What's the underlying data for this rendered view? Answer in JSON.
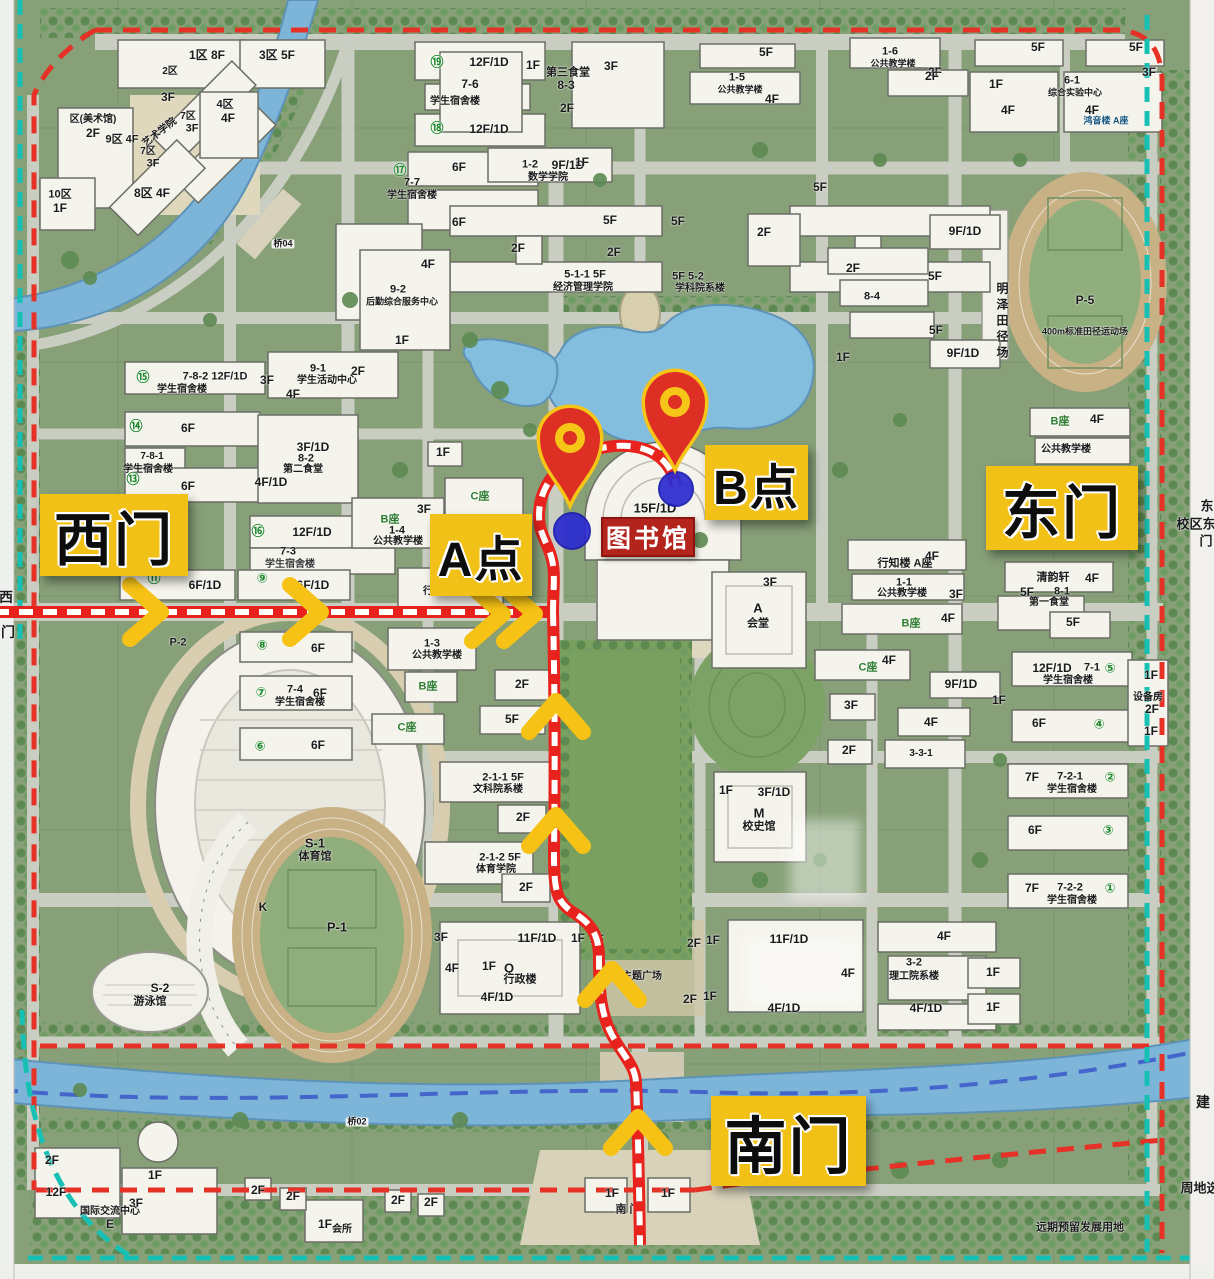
{
  "overlay": {
    "gates": [
      {
        "id": "west-gate",
        "label": "西门",
        "x": 40,
        "y": 494,
        "w": 148,
        "h": 82,
        "fs": 58
      },
      {
        "id": "east-gate",
        "label": "东门",
        "x": 986,
        "y": 466,
        "w": 152,
        "h": 84,
        "fs": 58
      },
      {
        "id": "south-gate",
        "label": "南门",
        "x": 711,
        "y": 1096,
        "w": 155,
        "h": 90,
        "fs": 62
      },
      {
        "id": "point-a",
        "label": "A点",
        "x": 430,
        "y": 514,
        "w": 102,
        "h": 82,
        "fs": 48
      },
      {
        "id": "point-b",
        "label": "B点",
        "x": 705,
        "y": 445,
        "w": 103,
        "h": 75,
        "fs": 48
      }
    ],
    "library_tag": {
      "label": "图书馆",
      "x": 601,
      "y": 517,
      "w": 90,
      "h": 36,
      "fs": 25
    },
    "pins": [
      {
        "x": 570,
        "y": 440
      },
      {
        "x": 675,
        "y": 404
      }
    ],
    "dots": [
      {
        "x": 572,
        "y": 531,
        "d": 36
      },
      {
        "x": 676,
        "y": 489,
        "d": 34
      }
    ],
    "chevrons": [
      {
        "x": 150,
        "y": 612,
        "dir": "right"
      },
      {
        "x": 310,
        "y": 612,
        "dir": "right"
      },
      {
        "x": 492,
        "y": 614,
        "dir": "right"
      },
      {
        "x": 524,
        "y": 614,
        "dir": "right"
      },
      {
        "x": 556,
        "y": 712,
        "dir": "up"
      },
      {
        "x": 556,
        "y": 826,
        "dir": "up"
      },
      {
        "x": 612,
        "y": 980,
        "dir": "up"
      },
      {
        "x": 638,
        "y": 1128,
        "dir": "up"
      }
    ],
    "colors": {
      "gate_bg": "#f2c117",
      "route_red": "#e8231d",
      "route_dash": "#ffffff",
      "chevron": "#f6c215",
      "pin_red": "#dd2f23",
      "pin_ring": "#f5c518",
      "dot_blue": "#2b2bd0",
      "library_bg": "#b3251c",
      "boundary_red": "#e63226",
      "teal_dash": "#17c0b4",
      "river_dash": "#3a57c8",
      "water": "#84bede"
    }
  },
  "map_labels": [
    {
      "t": "1区 8F",
      "x": 207,
      "y": 55
    },
    {
      "t": "2区",
      "x": 170,
      "y": 72,
      "fs": 10
    },
    {
      "t": "3区 5F",
      "x": 277,
      "y": 55
    },
    {
      "t": "3F",
      "x": 168,
      "y": 97
    },
    {
      "t": "4区",
      "x": 225,
      "y": 105,
      "fs": 11
    },
    {
      "t": "4F",
      "x": 228,
      "y": 118
    },
    {
      "t": "7区",
      "x": 188,
      "y": 117,
      "fs": 10
    },
    {
      "t": "3F",
      "x": 192,
      "y": 129,
      "fs": 11
    },
    {
      "t": "艺术学院",
      "x": 160,
      "y": 133,
      "fs": 10,
      "r": -38
    },
    {
      "t": "区(美术馆)",
      "x": 93,
      "y": 120,
      "fs": 10
    },
    {
      "t": "2F",
      "x": 93,
      "y": 133
    },
    {
      "t": "9区 4F",
      "x": 122,
      "y": 140,
      "fs": 11
    },
    {
      "t": "7区",
      "x": 148,
      "y": 152,
      "fs": 10
    },
    {
      "t": "3F",
      "x": 153,
      "y": 164,
      "fs": 11
    },
    {
      "t": "8区 4F",
      "x": 152,
      "y": 193
    },
    {
      "t": "10区",
      "x": 60,
      "y": 195,
      "fs": 11
    },
    {
      "t": "1F",
      "x": 60,
      "y": 208
    },
    {
      "t": "桥04",
      "x": 283,
      "y": 244,
      "fs": 9,
      "bg": 1
    },
    {
      "t": "⑲",
      "x": 437,
      "y": 62,
      "c": "#1f8a2e",
      "fs": 13
    },
    {
      "t": "12F/1D",
      "x": 489,
      "y": 62
    },
    {
      "t": "7-6",
      "x": 470,
      "y": 84
    },
    {
      "t": "学生宿舍楼",
      "x": 455,
      "y": 102,
      "fs": 10
    },
    {
      "t": "⑱",
      "x": 437,
      "y": 128,
      "c": "#1f8a2e",
      "fs": 13
    },
    {
      "t": "12F/1D",
      "x": 489,
      "y": 129
    },
    {
      "t": "1F",
      "x": 533,
      "y": 65
    },
    {
      "t": "第三食堂",
      "x": 568,
      "y": 73,
      "fs": 11
    },
    {
      "t": "8-3",
      "x": 566,
      "y": 85
    },
    {
      "t": "3F",
      "x": 611,
      "y": 66
    },
    {
      "t": "2F",
      "x": 567,
      "y": 108
    },
    {
      "t": "1-6",
      "x": 890,
      "y": 52,
      "fs": 11
    },
    {
      "t": "公共教学楼",
      "x": 893,
      "y": 64,
      "fs": 9
    },
    {
      "t": "2F",
      "x": 935,
      "y": 72
    },
    {
      "t": "5F",
      "x": 766,
      "y": 52
    },
    {
      "t": "1-5",
      "x": 737,
      "y": 78,
      "fs": 11
    },
    {
      "t": "公共教学楼",
      "x": 740,
      "y": 90,
      "fs": 9
    },
    {
      "t": "4F",
      "x": 772,
      "y": 99
    },
    {
      "t": "5F",
      "x": 1038,
      "y": 47
    },
    {
      "t": "5F",
      "x": 1136,
      "y": 47
    },
    {
      "t": "2F",
      "x": 932,
      "y": 76
    },
    {
      "t": "3F",
      "x": 1149,
      "y": 72
    },
    {
      "t": "1F",
      "x": 996,
      "y": 84
    },
    {
      "t": "6-1",
      "x": 1072,
      "y": 81,
      "fs": 11
    },
    {
      "t": "综合实验中心",
      "x": 1075,
      "y": 93,
      "fs": 9
    },
    {
      "t": "4F",
      "x": 1008,
      "y": 110
    },
    {
      "t": "4F",
      "x": 1092,
      "y": 110
    },
    {
      "t": "鸿音楼 A座",
      "x": 1106,
      "y": 121,
      "fs": 9,
      "c": "#14557e"
    },
    {
      "t": "5F",
      "x": 820,
      "y": 187
    },
    {
      "t": "⑰",
      "x": 400,
      "y": 170,
      "c": "#1f8a2e",
      "fs": 13
    },
    {
      "t": "7-7",
      "x": 412,
      "y": 183,
      "fs": 11
    },
    {
      "t": "学生宿舍楼",
      "x": 412,
      "y": 196,
      "fs": 10
    },
    {
      "t": "6F",
      "x": 459,
      "y": 167
    },
    {
      "t": "6F",
      "x": 459,
      "y": 222
    },
    {
      "t": "1-2",
      "x": 530,
      "y": 165,
      "fs": 11
    },
    {
      "t": "9F/1D",
      "x": 568,
      "y": 165
    },
    {
      "t": "数学学院",
      "x": 548,
      "y": 178,
      "fs": 10
    },
    {
      "t": "1F",
      "x": 582,
      "y": 162
    },
    {
      "t": "5F",
      "x": 610,
      "y": 220
    },
    {
      "t": "2F",
      "x": 518,
      "y": 248
    },
    {
      "t": "2F",
      "x": 614,
      "y": 252
    },
    {
      "t": "5-1-1 5F",
      "x": 585,
      "y": 275,
      "fs": 11
    },
    {
      "t": "经济管理学院",
      "x": 583,
      "y": 288,
      "fs": 10
    },
    {
      "t": "5F",
      "x": 678,
      "y": 221
    },
    {
      "t": "5F 5-2",
      "x": 688,
      "y": 277,
      "fs": 11
    },
    {
      "t": "学科院系楼",
      "x": 700,
      "y": 289,
      "fs": 10
    },
    {
      "t": "2F",
      "x": 764,
      "y": 232
    },
    {
      "t": "9F/1D",
      "x": 965,
      "y": 231
    },
    {
      "t": "2F",
      "x": 853,
      "y": 268
    },
    {
      "t": "8-4",
      "x": 872,
      "y": 297,
      "fs": 11
    },
    {
      "t": "5F",
      "x": 935,
      "y": 276
    },
    {
      "t": "5F",
      "x": 936,
      "y": 330
    },
    {
      "t": "9F/1D",
      "x": 963,
      "y": 353
    },
    {
      "t": "4F",
      "x": 428,
      "y": 264
    },
    {
      "t": "9-2",
      "x": 398,
      "y": 290,
      "fs": 11
    },
    {
      "t": "后勤综合服务中心",
      "x": 402,
      "y": 302,
      "fs": 9
    },
    {
      "t": "1F",
      "x": 402,
      "y": 340
    },
    {
      "t": "2F",
      "x": 358,
      "y": 371
    },
    {
      "t": "⑮",
      "x": 143,
      "y": 377,
      "c": "#1f8a2e",
      "fs": 13
    },
    {
      "t": "7-8-2 12F/1D",
      "x": 215,
      "y": 377,
      "fs": 11
    },
    {
      "t": "学生宿舍楼",
      "x": 182,
      "y": 390,
      "fs": 10
    },
    {
      "t": "⑭",
      "x": 136,
      "y": 426,
      "c": "#1f8a2e",
      "fs": 13
    },
    {
      "t": "6F",
      "x": 188,
      "y": 428
    },
    {
      "t": "7-8-1",
      "x": 152,
      "y": 457,
      "fs": 10
    },
    {
      "t": "学生宿舍楼",
      "x": 148,
      "y": 470,
      "fs": 10
    },
    {
      "t": "⑬",
      "x": 133,
      "y": 479,
      "c": "#1f8a2e",
      "fs": 13
    },
    {
      "t": "6F",
      "x": 188,
      "y": 486
    },
    {
      "t": "⑯",
      "x": 258,
      "y": 531,
      "c": "#1f8a2e",
      "fs": 13
    },
    {
      "t": "12F/1D",
      "x": 312,
      "y": 532
    },
    {
      "t": "7-3",
      "x": 288,
      "y": 552,
      "fs": 11
    },
    {
      "t": "学生宿舍楼",
      "x": 290,
      "y": 565,
      "fs": 10,
      "c": "#3a3a3a"
    },
    {
      "t": "9-1",
      "x": 318,
      "y": 369,
      "fs": 11
    },
    {
      "t": "学生活动中心",
      "x": 327,
      "y": 381,
      "fs": 10
    },
    {
      "t": "3F",
      "x": 267,
      "y": 380
    },
    {
      "t": "4F",
      "x": 293,
      "y": 394
    },
    {
      "t": "3F/1D",
      "x": 313,
      "y": 447
    },
    {
      "t": "8-2",
      "x": 306,
      "y": 459,
      "fs": 11
    },
    {
      "t": "第二食堂",
      "x": 303,
      "y": 470,
      "fs": 10
    },
    {
      "t": "4F/1D",
      "x": 271,
      "y": 482
    },
    {
      "t": "B座",
      "x": 390,
      "y": 520,
      "fs": 11,
      "c": "#2e7d32"
    },
    {
      "t": "1-4",
      "x": 397,
      "y": 531,
      "fs": 11
    },
    {
      "t": "公共教学楼",
      "x": 398,
      "y": 542,
      "fs": 10
    },
    {
      "t": "3F",
      "x": 424,
      "y": 509
    },
    {
      "t": "⑪",
      "x": 154,
      "y": 578,
      "c": "#1f8a2e",
      "fs": 13
    },
    {
      "t": "6F/1D",
      "x": 205,
      "y": 585
    },
    {
      "t": "⑨",
      "x": 262,
      "y": 578,
      "c": "#1f8a2e",
      "fs": 13
    },
    {
      "t": "6F/1D",
      "x": 313,
      "y": 585
    },
    {
      "t": "行思楼 A座",
      "x": 448,
      "y": 592,
      "fs": 10
    },
    {
      "t": "1-3",
      "x": 432,
      "y": 644,
      "fs": 11
    },
    {
      "t": "公共教学楼",
      "x": 437,
      "y": 656,
      "fs": 10
    },
    {
      "t": "P-2",
      "x": 178,
      "y": 643,
      "fs": 11
    },
    {
      "t": "⑧",
      "x": 262,
      "y": 645,
      "c": "#1f8a2e",
      "fs": 13
    },
    {
      "t": "6F",
      "x": 318,
      "y": 648
    },
    {
      "t": "⑦",
      "x": 261,
      "y": 692,
      "c": "#1f8a2e",
      "fs": 13
    },
    {
      "t": "7-4",
      "x": 295,
      "y": 690,
      "fs": 11
    },
    {
      "t": "6F",
      "x": 320,
      "y": 693
    },
    {
      "t": "学生宿舍楼",
      "x": 300,
      "y": 703,
      "fs": 10
    },
    {
      "t": "⑥",
      "x": 260,
      "y": 746,
      "c": "#1f8a2e",
      "fs": 13
    },
    {
      "t": "6F",
      "x": 318,
      "y": 745
    },
    {
      "t": "B座",
      "x": 428,
      "y": 687,
      "fs": 11,
      "c": "#2e7d32"
    },
    {
      "t": "2F",
      "x": 522,
      "y": 684
    },
    {
      "t": "C座",
      "x": 407,
      "y": 728,
      "fs": 11,
      "c": "#2e7d32"
    },
    {
      "t": "5F",
      "x": 512,
      "y": 719
    },
    {
      "t": "2-1-1 5F",
      "x": 503,
      "y": 778,
      "fs": 11
    },
    {
      "t": "文科院系楼",
      "x": 498,
      "y": 790,
      "fs": 10
    },
    {
      "t": "2F",
      "x": 523,
      "y": 817
    },
    {
      "t": "2-1-2 5F",
      "x": 500,
      "y": 858,
      "fs": 11
    },
    {
      "t": "体育学院",
      "x": 496,
      "y": 870,
      "fs": 10
    },
    {
      "t": "2F",
      "x": 526,
      "y": 887
    },
    {
      "t": "S-1",
      "x": 315,
      "y": 843,
      "fs": 13
    },
    {
      "t": "体育馆",
      "x": 315,
      "y": 857,
      "fs": 11
    },
    {
      "t": "K",
      "x": 263,
      "y": 907,
      "fs": 12
    },
    {
      "t": "P-1",
      "x": 337,
      "y": 927,
      "fs": 13
    },
    {
      "t": "S-2",
      "x": 160,
      "y": 988,
      "fs": 12
    },
    {
      "t": "游泳馆",
      "x": 150,
      "y": 1002,
      "fs": 11
    },
    {
      "t": "4F",
      "x": 659,
      "y": 455
    },
    {
      "t": "15F/1D",
      "x": 655,
      "y": 508,
      "fs": 13
    },
    {
      "t": "1F",
      "x": 443,
      "y": 452
    },
    {
      "t": "C座",
      "x": 480,
      "y": 497,
      "fs": 11,
      "c": "#2e7d32"
    },
    {
      "t": "3F",
      "x": 770,
      "y": 582
    },
    {
      "t": "A",
      "x": 758,
      "y": 608,
      "fs": 13
    },
    {
      "t": "会堂",
      "x": 758,
      "y": 624,
      "fs": 11
    },
    {
      "t": "M",
      "x": 759,
      "y": 813,
      "fs": 13
    },
    {
      "t": "校史馆",
      "x": 759,
      "y": 827,
      "fs": 11
    },
    {
      "t": "3F/1D",
      "x": 774,
      "y": 792
    },
    {
      "t": "1F",
      "x": 726,
      "y": 790
    },
    {
      "t": "1F",
      "x": 843,
      "y": 357
    },
    {
      "t": "11F/1D",
      "x": 537,
      "y": 938,
      "fs": 12
    },
    {
      "t": "1F",
      "x": 489,
      "y": 966
    },
    {
      "t": "Q",
      "x": 509,
      "y": 968,
      "fs": 13
    },
    {
      "t": "行政楼",
      "x": 520,
      "y": 980,
      "fs": 11
    },
    {
      "t": "4F/1D",
      "x": 497,
      "y": 997
    },
    {
      "t": "3F",
      "x": 441,
      "y": 937
    },
    {
      "t": "4F",
      "x": 452,
      "y": 968
    },
    {
      "t": "1F",
      "x": 578,
      "y": 938
    },
    {
      "t": "2F",
      "x": 597,
      "y": 939
    },
    {
      "t": "校史主题广场",
      "x": 632,
      "y": 977,
      "fs": 10
    },
    {
      "t": "2F",
      "x": 694,
      "y": 943
    },
    {
      "t": "1F",
      "x": 713,
      "y": 940
    },
    {
      "t": "2F",
      "x": 690,
      "y": 999
    },
    {
      "t": "1F",
      "x": 710,
      "y": 996
    },
    {
      "t": "11F/1D",
      "x": 789,
      "y": 939,
      "fs": 12
    },
    {
      "t": "4F",
      "x": 848,
      "y": 973
    },
    {
      "t": "4F/1D",
      "x": 784,
      "y": 1008
    },
    {
      "t": "4F",
      "x": 944,
      "y": 936
    },
    {
      "t": "3-2",
      "x": 914,
      "y": 963,
      "fs": 11
    },
    {
      "t": "理工院系楼",
      "x": 914,
      "y": 977,
      "fs": 10
    },
    {
      "t": "4F/1D",
      "x": 926,
      "y": 1008
    },
    {
      "t": "1F",
      "x": 993,
      "y": 972
    },
    {
      "t": "1F",
      "x": 993,
      "y": 1007
    },
    {
      "t": "行知楼 A座",
      "x": 905,
      "y": 564,
      "fs": 11
    },
    {
      "t": "4F",
      "x": 932,
      "y": 556
    },
    {
      "t": "1-1",
      "x": 904,
      "y": 583,
      "fs": 11
    },
    {
      "t": "公共教学楼",
      "x": 902,
      "y": 594,
      "fs": 10
    },
    {
      "t": "3F",
      "x": 956,
      "y": 594
    },
    {
      "t": "B座",
      "x": 911,
      "y": 624,
      "fs": 11,
      "c": "#2e7d32"
    },
    {
      "t": "4F",
      "x": 948,
      "y": 618
    },
    {
      "t": "C座",
      "x": 868,
      "y": 668,
      "fs": 11,
      "c": "#2e7d32"
    },
    {
      "t": "4F",
      "x": 889,
      "y": 660
    },
    {
      "t": "9F/1D",
      "x": 961,
      "y": 684
    },
    {
      "t": "1F",
      "x": 999,
      "y": 700
    },
    {
      "t": "3F",
      "x": 851,
      "y": 705
    },
    {
      "t": "4F",
      "x": 931,
      "y": 722
    },
    {
      "t": "2F",
      "x": 849,
      "y": 750
    },
    {
      "t": "3-3-1",
      "x": 921,
      "y": 754,
      "fs": 10
    },
    {
      "t": "清韵轩",
      "x": 1053,
      "y": 578,
      "fs": 11
    },
    {
      "t": "4F",
      "x": 1092,
      "y": 578
    },
    {
      "t": "5F",
      "x": 1027,
      "y": 592
    },
    {
      "t": "8-1",
      "x": 1062,
      "y": 592,
      "fs": 11
    },
    {
      "t": "第一食堂",
      "x": 1049,
      "y": 603,
      "fs": 10
    },
    {
      "t": "5F",
      "x": 1073,
      "y": 622
    },
    {
      "t": "12F/1D",
      "x": 1052,
      "y": 668
    },
    {
      "t": "7-1",
      "x": 1092,
      "y": 668,
      "fs": 11
    },
    {
      "t": "⑤",
      "x": 1110,
      "y": 668,
      "c": "#1f8a2e",
      "fs": 13
    },
    {
      "t": "学生宿舍楼",
      "x": 1068,
      "y": 681,
      "fs": 10
    },
    {
      "t": "1F",
      "x": 1151,
      "y": 675
    },
    {
      "t": "设备房",
      "x": 1148,
      "y": 698,
      "fs": 10
    },
    {
      "t": "2F",
      "x": 1152,
      "y": 709
    },
    {
      "t": "1F",
      "x": 1151,
      "y": 731
    },
    {
      "t": "6F",
      "x": 1039,
      "y": 723
    },
    {
      "t": "④",
      "x": 1099,
      "y": 724,
      "c": "#1f8a2e",
      "fs": 13
    },
    {
      "t": "B座",
      "x": 1060,
      "y": 422,
      "fs": 11,
      "c": "#2e7d32"
    },
    {
      "t": "4F",
      "x": 1097,
      "y": 419
    },
    {
      "t": "公共教学楼",
      "x": 1066,
      "y": 450,
      "fs": 10
    },
    {
      "t": "7F",
      "x": 1032,
      "y": 777
    },
    {
      "t": "7-2-1",
      "x": 1070,
      "y": 777,
      "fs": 11
    },
    {
      "t": "学生宿舍楼",
      "x": 1072,
      "y": 790,
      "fs": 10
    },
    {
      "t": "②",
      "x": 1110,
      "y": 777,
      "c": "#1f8a2e",
      "fs": 13
    },
    {
      "t": "6F",
      "x": 1035,
      "y": 830
    },
    {
      "t": "③",
      "x": 1108,
      "y": 830,
      "c": "#1f8a2e",
      "fs": 13
    },
    {
      "t": "7F",
      "x": 1032,
      "y": 888
    },
    {
      "t": "7-2-2",
      "x": 1070,
      "y": 888,
      "fs": 11
    },
    {
      "t": "学生宿舍楼",
      "x": 1072,
      "y": 901,
      "fs": 10
    },
    {
      "t": "①",
      "x": 1110,
      "y": 888,
      "c": "#1f8a2e",
      "fs": 13
    },
    {
      "t": "明泽田径场",
      "x": 1002,
      "y": 322,
      "fs": 12,
      "v": 1
    },
    {
      "t": "P-5",
      "x": 1085,
      "y": 300,
      "fs": 12
    },
    {
      "t": "400m标准田径运动场",
      "x": 1085,
      "y": 332,
      "fs": 9
    },
    {
      "t": "2F",
      "x": 52,
      "y": 1160
    },
    {
      "t": "1F",
      "x": 155,
      "y": 1175
    },
    {
      "t": "12F",
      "x": 56,
      "y": 1192
    },
    {
      "t": "3F",
      "x": 136,
      "y": 1203
    },
    {
      "t": "国际交流中心",
      "x": 110,
      "y": 1212,
      "fs": 10
    },
    {
      "t": "E",
      "x": 110,
      "y": 1224,
      "fs": 12
    },
    {
      "t": "2F",
      "x": 258,
      "y": 1190
    },
    {
      "t": "2F",
      "x": 293,
      "y": 1196
    },
    {
      "t": "1F",
      "x": 325,
      "y": 1224
    },
    {
      "t": "会所",
      "x": 342,
      "y": 1230,
      "fs": 10
    },
    {
      "t": "2F",
      "x": 398,
      "y": 1200
    },
    {
      "t": "2F",
      "x": 431,
      "y": 1202
    },
    {
      "t": "桥02",
      "x": 357,
      "y": 1122,
      "fs": 9,
      "bg": 1
    },
    {
      "t": "南 门",
      "x": 628,
      "y": 1210,
      "fs": 11
    },
    {
      "t": "1F",
      "x": 612,
      "y": 1193
    },
    {
      "t": "1F",
      "x": 668,
      "y": 1193
    },
    {
      "t": "远期预留发展用地",
      "x": 1080,
      "y": 1228,
      "fs": 11
    },
    {
      "t": "西",
      "x": 6,
      "y": 597,
      "fs": 14
    },
    {
      "t": "门",
      "x": 8,
      "y": 632,
      "fs": 14
    },
    {
      "t": "东",
      "x": 1207,
      "y": 506,
      "fs": 13
    },
    {
      "t": "校区东",
      "x": 1196,
      "y": 524,
      "fs": 13
    },
    {
      "t": "门",
      "x": 1206,
      "y": 541,
      "fs": 13
    },
    {
      "t": "建",
      "x": 1203,
      "y": 1102,
      "fs": 14
    },
    {
      "t": "周地选",
      "x": 1200,
      "y": 1188,
      "fs": 13
    }
  ]
}
